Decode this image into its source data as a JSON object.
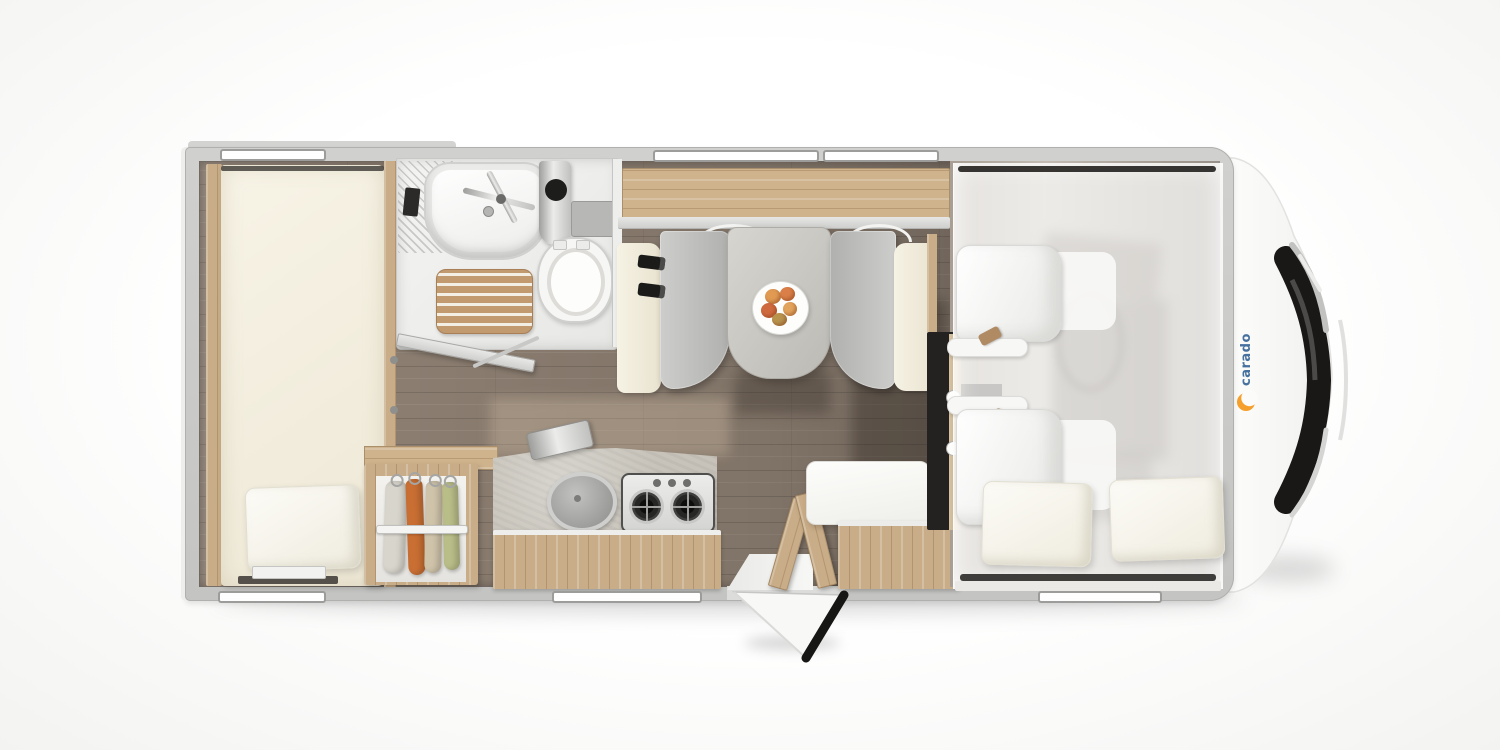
{
  "scene": {
    "type": "motorhome-floorplan-top-view",
    "vehicle_front": "right"
  },
  "brand": {
    "logo_text": "carado",
    "logo_blue": "#46719f",
    "logo_orange": "#f5a02d"
  },
  "palette": {
    "background": "#f7f7f5",
    "wall_grey": "#c8c8c6",
    "floor_wood": "#8b7d70",
    "furniture_oak": "#c9ad88",
    "upholstery_cream": "#f4f0e2",
    "bench_grey": "#bdbdbb",
    "counter_concrete": "#c7c3ba",
    "accent_dark": "#1b1b19",
    "cloth_orange": "#c96f33",
    "cloth_green": "#b9bd88"
  },
  "rooms": [
    {
      "name": "rear-bedroom",
      "furniture": [
        "single-bed",
        "pillow",
        "side-wood-frame"
      ]
    },
    {
      "name": "bathroom",
      "furniture": [
        "washbasin",
        "faucet",
        "shower-column",
        "toilet",
        "cistern",
        "wooden-shower-mat",
        "open-bathroom-door"
      ]
    },
    {
      "name": "wardrobe",
      "furniture": [
        "clothes-rail",
        "four-hanging-garments"
      ]
    },
    {
      "name": "kitchen",
      "furniture": [
        "worktop",
        "round-sink-cover",
        "two-burner-gas-hob",
        "drawer-front",
        "leaning-lid"
      ]
    },
    {
      "name": "dinette",
      "furniture": [
        "left-bench",
        "right-bench",
        "table",
        "plate-with-fruit",
        "seat-belts",
        "overhead-sideboard"
      ]
    },
    {
      "name": "entrance",
      "furniture": [
        "entry-step",
        "open-entry-door",
        "side-bench",
        "drawer-cabinet",
        "partition-panels"
      ]
    },
    {
      "name": "cab",
      "furniture": [
        "driver-seat",
        "passenger-seat",
        "dashboard",
        "drop-down-bed",
        "two-pillows",
        "windshield",
        "brand-logo"
      ]
    }
  ]
}
